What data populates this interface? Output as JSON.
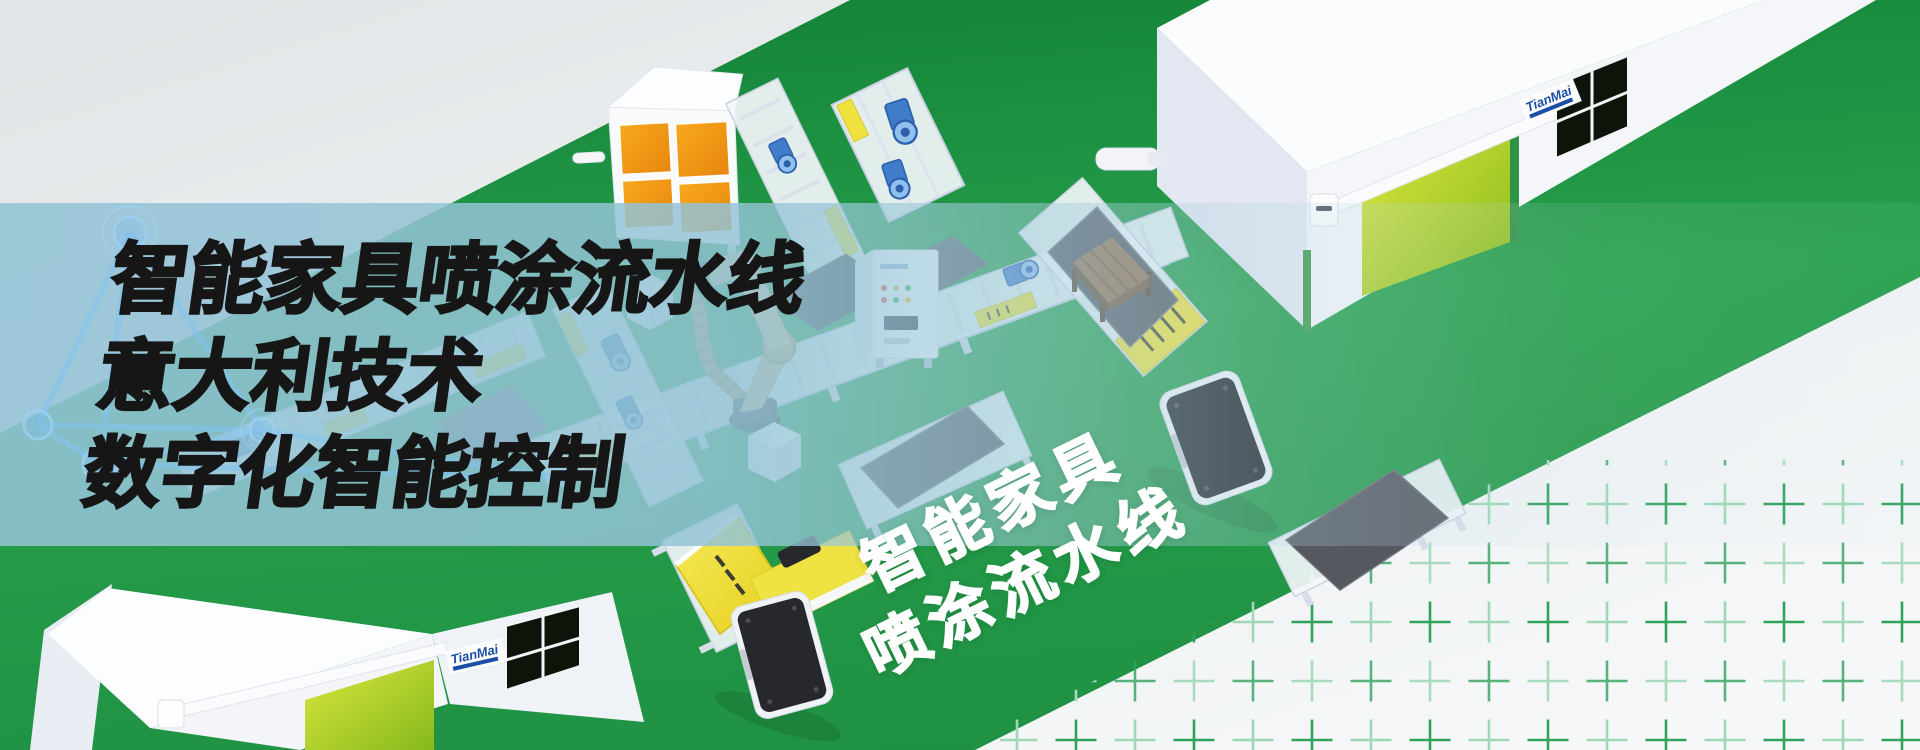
{
  "banner": {
    "title_lines": [
      "智能家具喷涂流水线",
      "意大利技术",
      "数字化智能控制"
    ],
    "floor_label_lines": [
      "智能家具",
      "喷涂流水线"
    ]
  },
  "brand": {
    "logo": "TianMai"
  },
  "colors": {
    "road_green": "#1f9143",
    "overlay_band_blue": "#9ec9d9",
    "door_yellow_green": "#b8d52c",
    "booth_orange": "#f29a19",
    "plus_mark_green": "#2fa35c",
    "title_black": "#161616",
    "floor_text_white": "#ffffff",
    "brand_blue": "#1b4fa5"
  },
  "scene_objects": [
    "factory-building-top-right",
    "factory-building-bottom-left",
    "spray-booth-cabinet",
    "pump-station-conveyor",
    "long-conveyor-line",
    "cross-conveyors",
    "paint-robot-arm",
    "furniture-boards",
    "wood-table",
    "control-cabinet",
    "agv-robots",
    "network-wireframe",
    "plus-mark-grid"
  ]
}
